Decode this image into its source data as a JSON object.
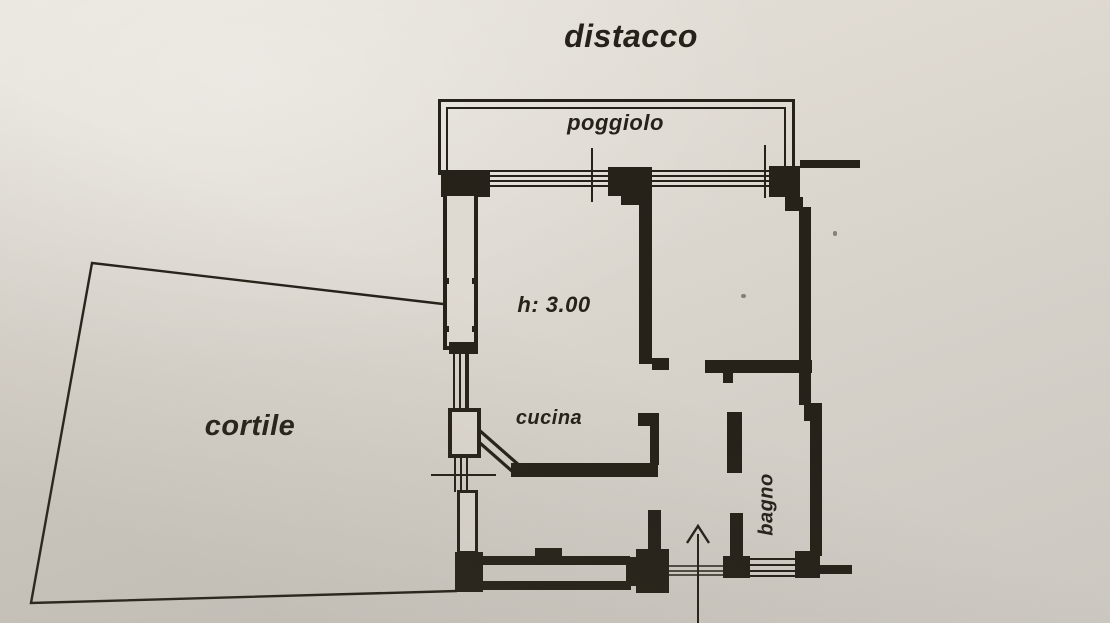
{
  "document": {
    "type": "floor-plan-scan",
    "colors": {
      "paper": "#ddd8d0",
      "ink": "#262219"
    }
  },
  "labels": {
    "distacco": "distacco",
    "poggiolo": "poggiolo",
    "room_height": "h: 3.00",
    "cucina": "cucina",
    "cortile": "cortile",
    "bagno": "bagno"
  }
}
